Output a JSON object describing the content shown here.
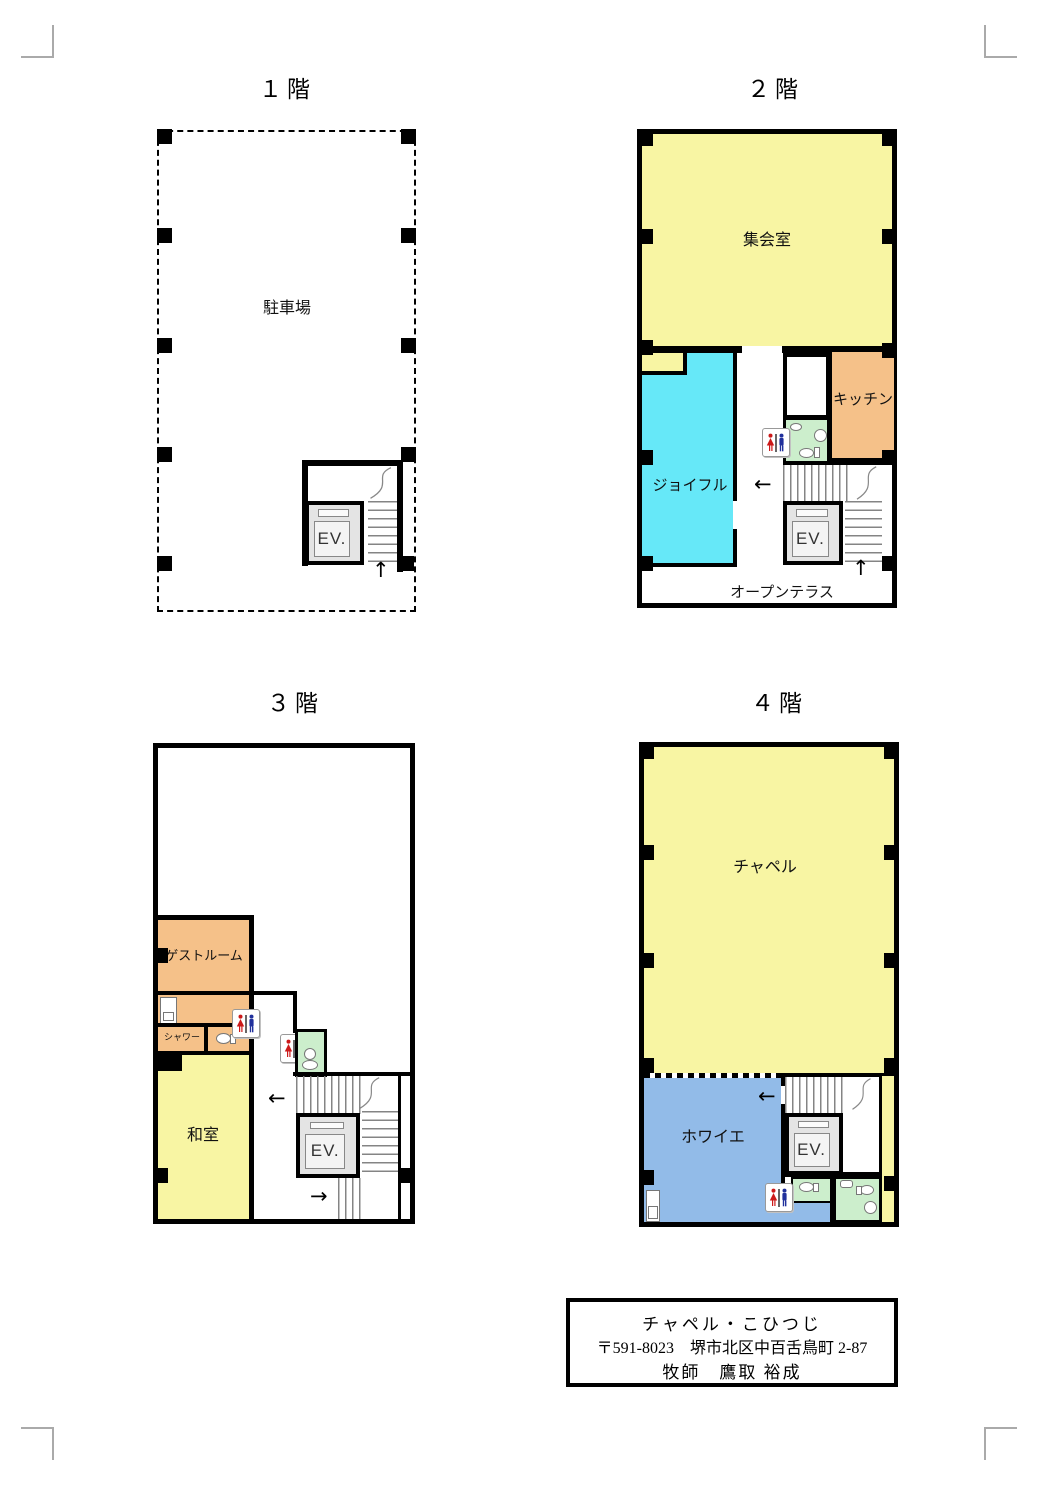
{
  "colors": {
    "room_yellow": "#F8F5A3",
    "room_cyan": "#66E8F8",
    "room_orange": "#F5C189",
    "room_green": "#CCEECC",
    "room_blue": "#92BBE8",
    "wall_black": "#000000",
    "crop_mark_gray": "#AAAAAA",
    "ev_gray": "#E4E4E4"
  },
  "icons": {
    "up_arrow": "↑",
    "left_arrow": "←",
    "right_arrow": "→"
  },
  "f1": {
    "title": "１階",
    "parking": "駐車場",
    "ev": "EV."
  },
  "f2": {
    "title": "２階",
    "hall": "集会室",
    "joyful": "ジョイフル",
    "kitchen": "キッチン",
    "terrace": "オープンテラス",
    "ev": "EV."
  },
  "f3": {
    "title": "３階",
    "guest": "ゲストルーム",
    "shower": "シャワー",
    "washitsu": "和室",
    "ev": "EV."
  },
  "f4": {
    "title": "４階",
    "chapel": "チャペル",
    "foyer": "ホワイエ",
    "ev": "EV."
  },
  "info": {
    "name": "チャペル・こひつじ",
    "address": "〒591-8023　堺市北区中百舌鳥町 2-87",
    "pastor": "牧師　鷹取 裕成"
  }
}
